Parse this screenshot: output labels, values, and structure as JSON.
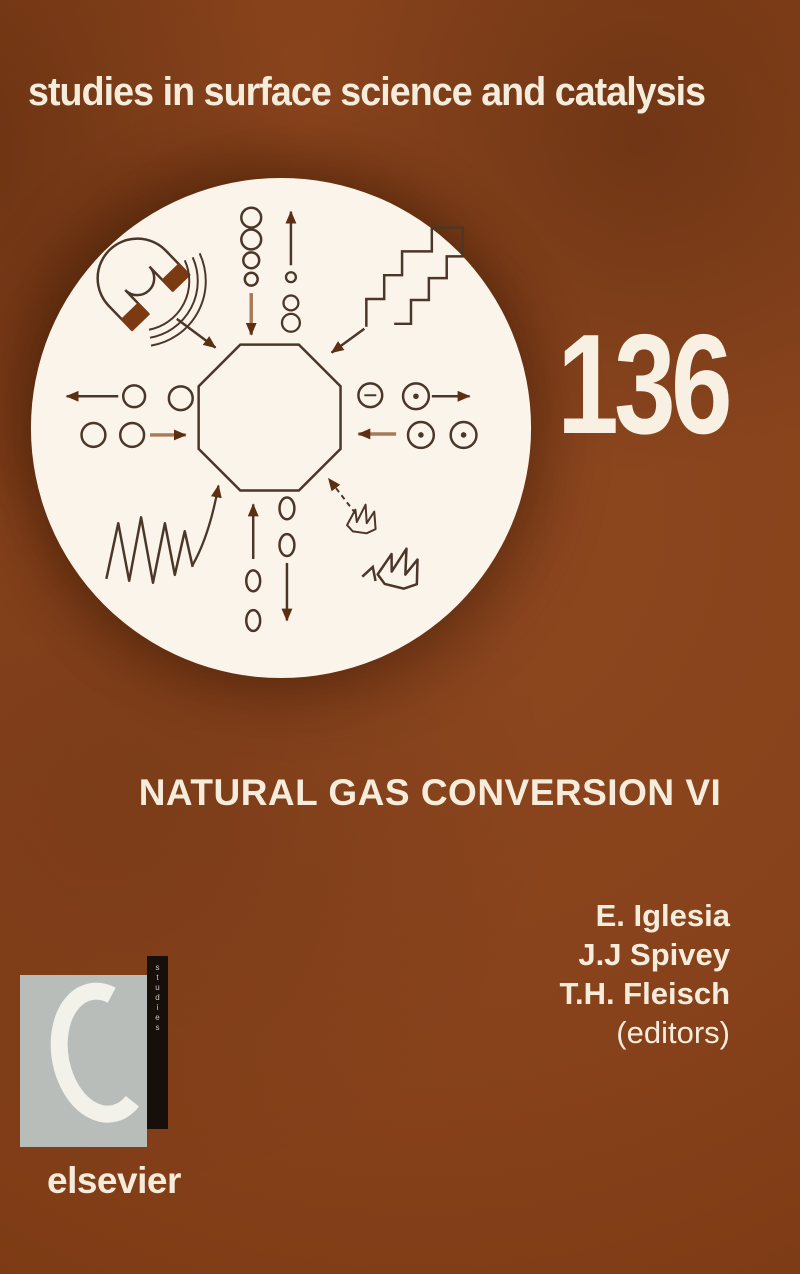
{
  "cover": {
    "series_title": "studies in surface science and catalysis",
    "volume_number": "136",
    "book_title": "NATURAL GAS CONVERSION VI",
    "editors": [
      "E. Iglesia",
      "J.J Spivey",
      "T.H. Fleisch"
    ],
    "editors_suffix": "(editors)",
    "publisher_wordmark": "elsevier",
    "spine_vertical_text": "studies",
    "colors": {
      "background": "#87421B",
      "text_cream": "#F6ECDC",
      "emblem_background": "#FBF4EA",
      "emblem_line": "#4B3629",
      "emblem_light_line": "#A87A57",
      "emblem_accent": "#7C3A13",
      "arrowhead": "#5C2E12",
      "logo_gray": "#B9BDB9",
      "logo_bar_black": "#17100A",
      "logo_c_white": "#F2F1EA"
    },
    "emblem": {
      "shape": "octagon-reactor-in-circle",
      "icons": [
        "magnet-icon",
        "staircase-icon",
        "molecule-rings",
        "dotted-molecule-rings",
        "oval-molecules",
        "wave-squiggle-icon",
        "crown-icon",
        "arrow-icons"
      ]
    }
  }
}
